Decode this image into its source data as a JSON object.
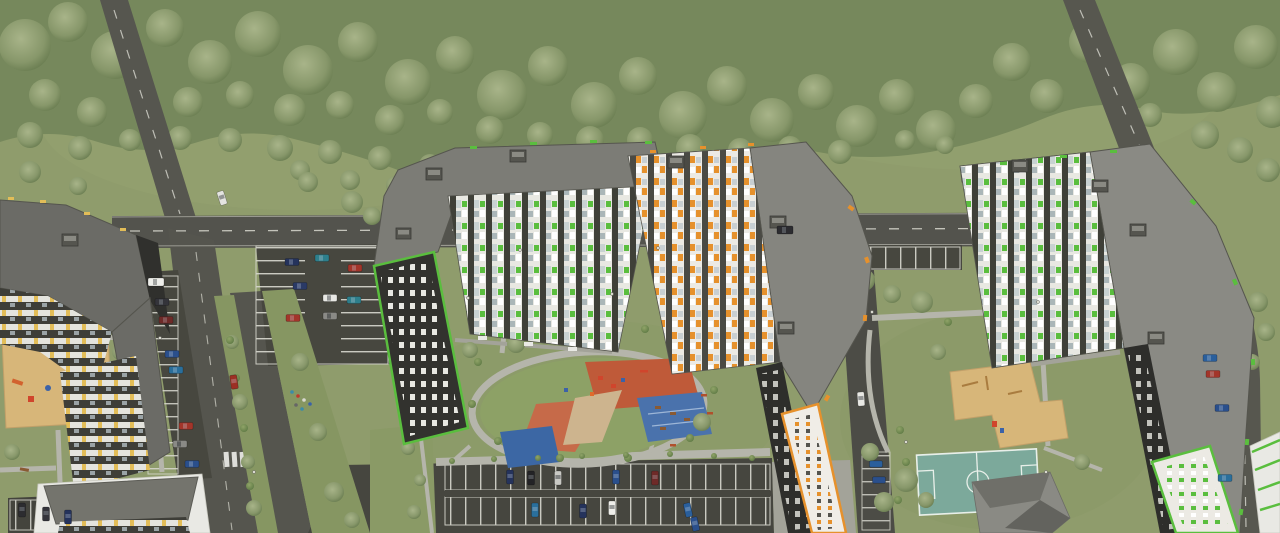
{
  "scene": {
    "type": "aerial-3d-architectural-render",
    "subject": "residential apartment complex with landscaped courtyards, playgrounds, football pitch, boulevard and parking lots, bordered by a forest belt",
    "camera": "high-angle aerial perspective",
    "palette": {
      "grass": "#8f9c6c",
      "forest": "#76885c",
      "tree_light": "#a8b489",
      "tree_dark": "#73855a",
      "road": "#53534d",
      "parking_asphalt": "#47473f",
      "stall_line": "#d9d9d0",
      "roof_gray": "#7d7d78",
      "facade_white": "#e8e8e2",
      "facade_dark": "#32322e",
      "accent_green": "#5abe3e",
      "accent_orange": "#e6912c",
      "accent_yellow": "#e2bd58",
      "playground_red": "#bf5a39",
      "playground_blue": "#4a72ac",
      "field_teal": "#7ca99b",
      "sand": "#d7b679",
      "path": "#b5b5ab"
    },
    "buildings": [
      {
        "name": "tower-left-yellow",
        "accent": "#e2bd58",
        "form": "L-shaped mid-rise, gray roof, yellow balcony accents"
      },
      {
        "name": "low-building-white-left",
        "accent": "#e2bd58",
        "form": "low white block, gray roof"
      },
      {
        "name": "tower-center-left-green",
        "accent": "#5abe3e",
        "form": "L-shaped high-rise, green window accents, dark side wall with green frame"
      },
      {
        "name": "tower-center-orange",
        "accent": "#e6912c",
        "form": "L-shaped high-rise, orange window accents, orange-framed side wall"
      },
      {
        "name": "tower-right-green",
        "accent": "#5abe3e",
        "form": "L-shaped high-rise, green window accents, large gray roof"
      },
      {
        "name": "utility-building-gray",
        "accent": "#8a8a84",
        "form": "small angular service building"
      },
      {
        "name": "corner-building-right-green",
        "accent": "#5abe3e",
        "form": "white block with green stripes at lower right corner"
      }
    ],
    "amenities": [
      "central-oval-park-with-ring-path",
      "red-rubber-playgrounds",
      "blue-sports-and-seating-areas",
      "sand-playgrounds",
      "football-field-with-white-markings",
      "benches",
      "street-lights"
    ],
    "infrastructure": {
      "roads": [
        "diagonal-access-road-upper-left",
        "main-horizontal-road-across-center",
        "diagonal-road-upper-right-curving-down-right-edge",
        "vertical-boulevard-with-green-median-lower-left"
      ],
      "parking": [
        "lot-near-intersection",
        "stalls-along-boulevard",
        "row-by-main-road",
        "large-lot-bottom-center",
        "pad-bottom-left",
        "stalls-right-edge"
      ],
      "crosswalk": "zebra-crossing-on-boulevard"
    },
    "vehicles_colors": [
      "white",
      "silver",
      "gray",
      "black",
      "navy",
      "blue",
      "teal",
      "red",
      "dark-red"
    ],
    "vegetation": [
      "forest-belt-top",
      "scattered-trees",
      "hedges-and-bushes",
      "lawns"
    ]
  }
}
